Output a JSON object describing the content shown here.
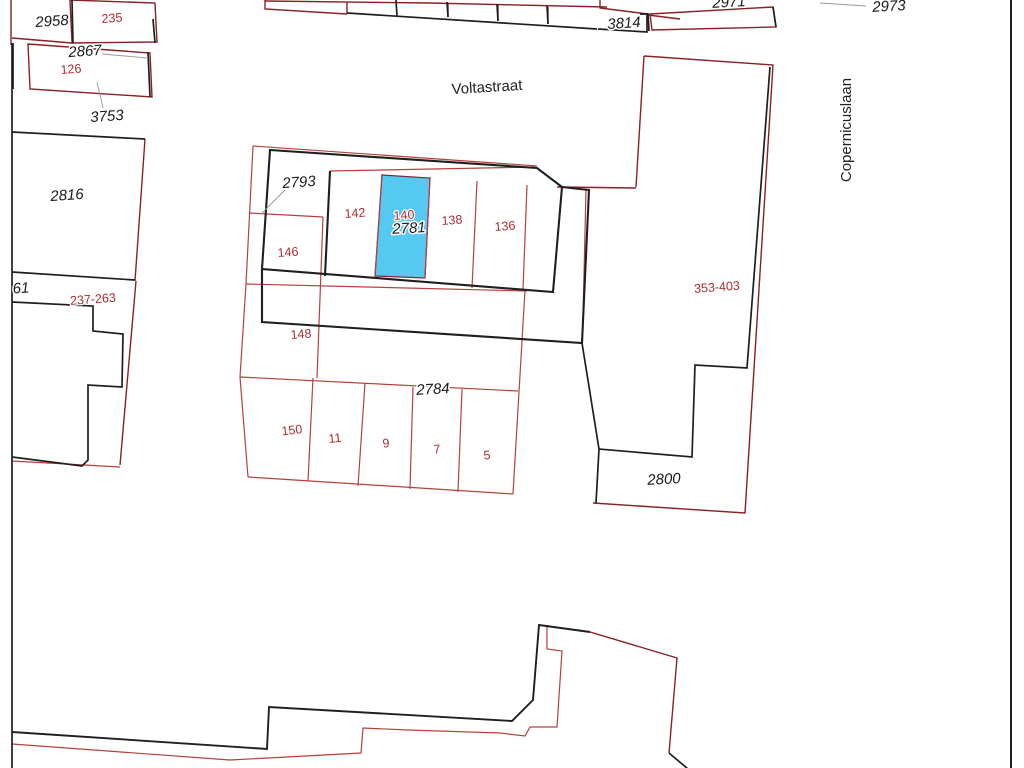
{
  "map": {
    "type": "cadastral-parcel-map",
    "background": "#ffffff",
    "colors": {
      "building_line": "#1f1f1f",
      "parcel_line_dark": "#8a2025",
      "parcel_line_light": "#b5403d",
      "leader_line": "#999999",
      "highlight_fill": "#55c9f2",
      "highlight_edge": "#7a2a2e",
      "label_black": "#1a1a1a",
      "label_red": "#ac2b30"
    },
    "highlighted_parcel": {
      "cadastral_number": "2781",
      "house_number": "140"
    },
    "streets": [
      "Voltastraat",
      "Copernicuslaan"
    ],
    "labels": [
      {
        "text": "2958",
        "kind": "cadastral",
        "x": 52,
        "y": 22,
        "rot": -4
      },
      {
        "text": "235",
        "kind": "address",
        "x": 112,
        "y": 19,
        "rot": -4
      },
      {
        "text": "2867",
        "kind": "cadastral",
        "x": 85,
        "y": 52,
        "rot": -4
      },
      {
        "text": "126",
        "kind": "address",
        "x": 71,
        "y": 70,
        "rot": -4
      },
      {
        "text": "3753",
        "kind": "cadastral",
        "x": 107,
        "y": 117,
        "rot": -4
      },
      {
        "text": "2816",
        "kind": "cadastral",
        "x": 67,
        "y": 196,
        "rot": -4
      },
      {
        "text": "61",
        "kind": "cadastral",
        "x": 21,
        "y": 289,
        "rot": -4
      },
      {
        "text": "237-263",
        "kind": "address",
        "x": 93,
        "y": 300,
        "rot": -4
      },
      {
        "text": "3814",
        "kind": "cadastral",
        "x": 624,
        "y": 24,
        "rot": -4
      },
      {
        "text": "2971",
        "kind": "cadastral",
        "x": 729,
        "y": 3,
        "rot": -3
      },
      {
        "text": "2973",
        "kind": "cadastral",
        "x": 889,
        "y": 7,
        "rot": -3
      },
      {
        "text": "2793",
        "kind": "cadastral",
        "x": 299,
        "y": 183,
        "rot": -4
      },
      {
        "text": "142",
        "kind": "address",
        "x": 355,
        "y": 214,
        "rot": -4
      },
      {
        "text": "140",
        "kind": "address",
        "x": 404,
        "y": 216,
        "rot": -4,
        "size": 11.5
      },
      {
        "text": "2781",
        "kind": "cadastral",
        "x": 409,
        "y": 229,
        "rot": -3
      },
      {
        "text": "138",
        "kind": "address",
        "x": 452,
        "y": 221,
        "rot": -4
      },
      {
        "text": "136",
        "kind": "address",
        "x": 505,
        "y": 227,
        "rot": -4
      },
      {
        "text": "146",
        "kind": "address",
        "x": 288,
        "y": 253,
        "rot": -4
      },
      {
        "text": "353-403",
        "kind": "address",
        "x": 717,
        "y": 288,
        "rot": -4
      },
      {
        "text": "148",
        "kind": "address",
        "x": 301,
        "y": 335,
        "rot": -4
      },
      {
        "text": "2784",
        "kind": "cadastral",
        "x": 433,
        "y": 390,
        "rot": -3
      },
      {
        "text": "150",
        "kind": "address",
        "x": 292,
        "y": 431,
        "rot": -6
      },
      {
        "text": "11",
        "kind": "address",
        "x": 335,
        "y": 439,
        "rot": -6
      },
      {
        "text": "9",
        "kind": "address",
        "x": 386,
        "y": 444,
        "rot": -5
      },
      {
        "text": "7",
        "kind": "address",
        "x": 437,
        "y": 450,
        "rot": -5
      },
      {
        "text": "5",
        "kind": "address",
        "x": 487,
        "y": 456,
        "rot": -5
      },
      {
        "text": "2800",
        "kind": "cadastral",
        "x": 664,
        "y": 480,
        "rot": -3
      },
      {
        "text": "Voltastraat",
        "kind": "street",
        "x": 487,
        "y": 88,
        "rot": -3.5
      },
      {
        "text": "Copernicuslaan",
        "kind": "street",
        "x": 847,
        "y": 130,
        "rot": -90,
        "size": 14
      }
    ]
  }
}
